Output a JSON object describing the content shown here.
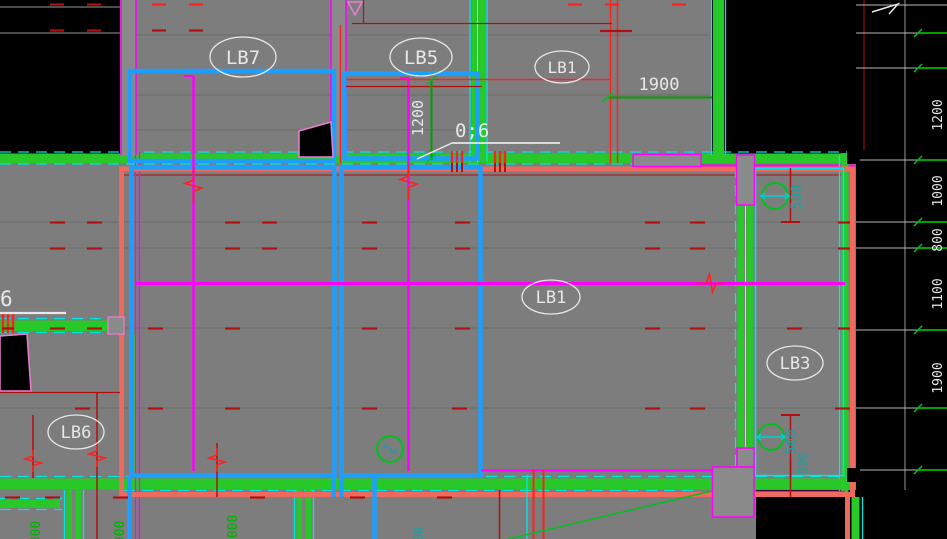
{
  "canvas": {
    "width": 947,
    "height": 539,
    "app_type": "cad-structural-plan"
  },
  "palette": {
    "background": "#000000",
    "slab_gray": "#7d7d7d",
    "wall_green": "#28c828",
    "dimension_green": "#00a000",
    "cyan": "#00e5e5",
    "teal_text": "#1f9e9e",
    "salmon": "#ef6a5e",
    "magenta": "#ff00ff",
    "pink_outline": "#e87fd0",
    "red_bright": "#ff2020",
    "red_dark": "#b01010",
    "beam_blue": "#1e9fff",
    "text_white": "#e8e8e8"
  },
  "labels": {
    "lb7": "LB7",
    "lb5": "LB5",
    "lb1_top": "LB1",
    "lb1_mid": "LB1",
    "lb3": "LB3",
    "lb6": "LB6"
  },
  "annotations": {
    "dim_1900": "1900",
    "dim_1200": "1200",
    "note_mid": "0;6",
    "note_left": "6",
    "col_dim_top": "500",
    "col_dim_bottom": "500",
    "col_dim_corner": "500"
  },
  "right_margin_dims": [
    "1200",
    "1000",
    "800",
    "1100",
    "1900"
  ],
  "bottom_margin_dims": [
    "1000",
    "1000",
    "1000",
    "500"
  ]
}
